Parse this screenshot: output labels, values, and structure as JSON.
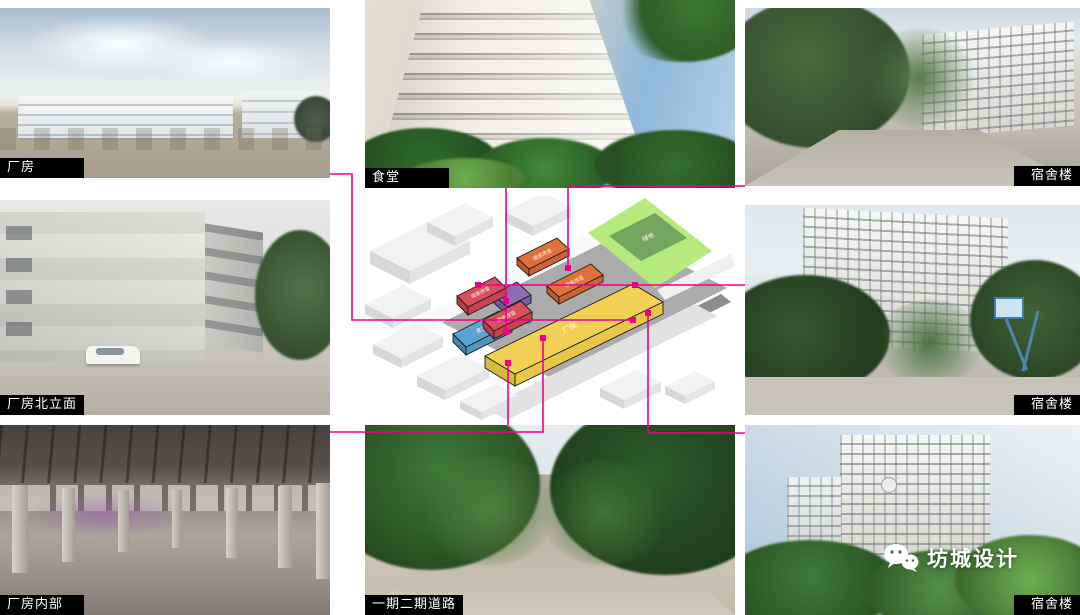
{
  "page": {
    "background": "#ffffff"
  },
  "connector": {
    "color": "#ec008c"
  },
  "photos": {
    "factory": {
      "label": "厂房"
    },
    "canteen": {
      "label": "食堂"
    },
    "dorm_top": {
      "label": "宿舍楼"
    },
    "factory_north": {
      "label": "厂房北立面"
    },
    "dorm_mid": {
      "label": "宿舍楼"
    },
    "factory_interior": {
      "label": "厂房内部"
    },
    "road": {
      "label": "一期二期道路"
    },
    "dorm_bottom": {
      "label": "宿舍楼"
    }
  },
  "diagram": {
    "labels": {
      "red_dorm_1": "宿舍改造",
      "red_dorm_2": "宿舍改造",
      "orange_dorm_1": "宿舍改造",
      "orange_dorm_2": "宿舍改造",
      "canteen": "食堂",
      "factory": "厂房",
      "green_space": "绿地"
    },
    "colors": {
      "red": "#d94f5c",
      "orange": "#e0703c",
      "yellow": "#f2d054",
      "purple": "#8d6cb5",
      "blue": "#5ba3d0",
      "green_zone": "#b7ea7e",
      "green_building": "#76a55f"
    }
  },
  "watermark": {
    "brand": "坊城设计"
  }
}
